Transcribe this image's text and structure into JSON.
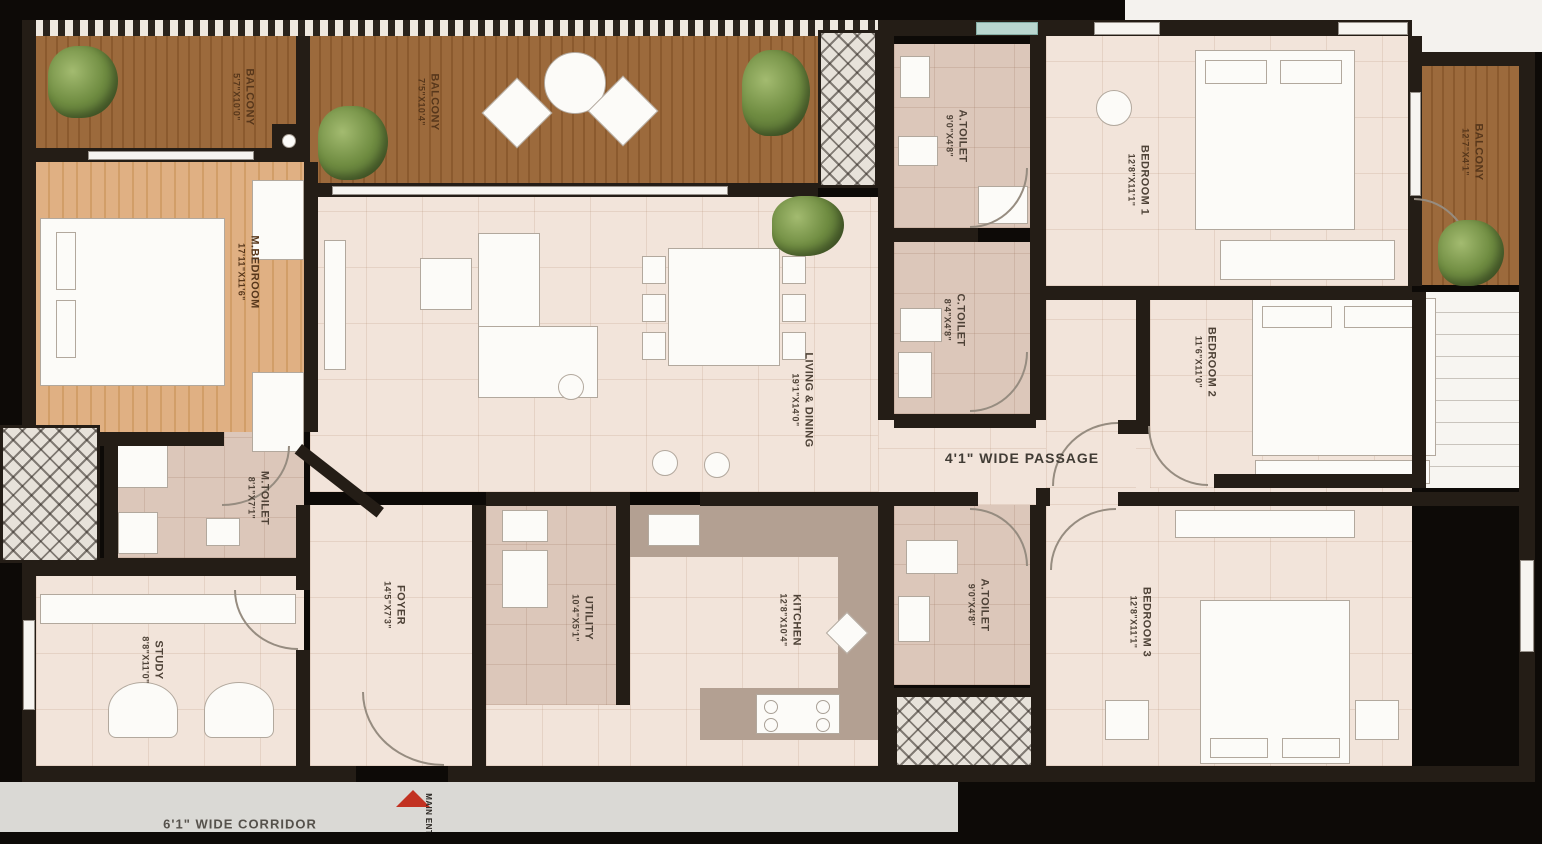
{
  "rooms": {
    "balcony_tl": {
      "name": "BALCONY",
      "dim": "5'7\"X10'0\""
    },
    "balcony_top": {
      "name": "BALCONY",
      "dim": "7'5\"X10'4\""
    },
    "balcony_right": {
      "name": "BALCONY",
      "dim": "12'7\"X4'1\""
    },
    "m_bedroom": {
      "name": "M.BEDROOM",
      "dim": "17'11\"X11'6\""
    },
    "living_dining": {
      "name": "LIVING & DINING",
      "dim": "19'1\"X14'0\""
    },
    "a_toilet_top": {
      "name": "A.TOILET",
      "dim": "9'0\"X4'8\""
    },
    "c_toilet": {
      "name": "C.TOILET",
      "dim": "8'4\"X4'8\""
    },
    "bedroom1": {
      "name": "BEDROOM 1",
      "dim": "12'8\"X11'1\""
    },
    "bedroom2": {
      "name": "BEDROOM 2",
      "dim": "11'6\"X11'0\""
    },
    "bedroom3": {
      "name": "BEDROOM 3",
      "dim": "12'8\"X11'1\""
    },
    "kitchen": {
      "name": "KITCHEN",
      "dim": "12'8\"X10'4\""
    },
    "utility": {
      "name": "UTILITY",
      "dim": "10'4\"X5'1\""
    },
    "foyer": {
      "name": "FOYER",
      "dim": "14'5\"X7'3\""
    },
    "m_toilet": {
      "name": "M.TOILET",
      "dim": "8'1\"X7'1\""
    },
    "a_toilet_bottom": {
      "name": "A.TOILET",
      "dim": "9'0\"X4'8\""
    },
    "study": {
      "name": "STUDY",
      "dim": "8'8\"X11'0\""
    }
  },
  "annotations": {
    "passage": "4'1\" WIDE PASSAGE",
    "corridor": "6'1\" WIDE CORRIDOR",
    "main_entry": "MAIN ENTRY"
  },
  "colors": {
    "wall": "#241d16",
    "wood": "#9c6a3c",
    "tile": "#f2e4da",
    "entry_arrow": "#c23222"
  }
}
